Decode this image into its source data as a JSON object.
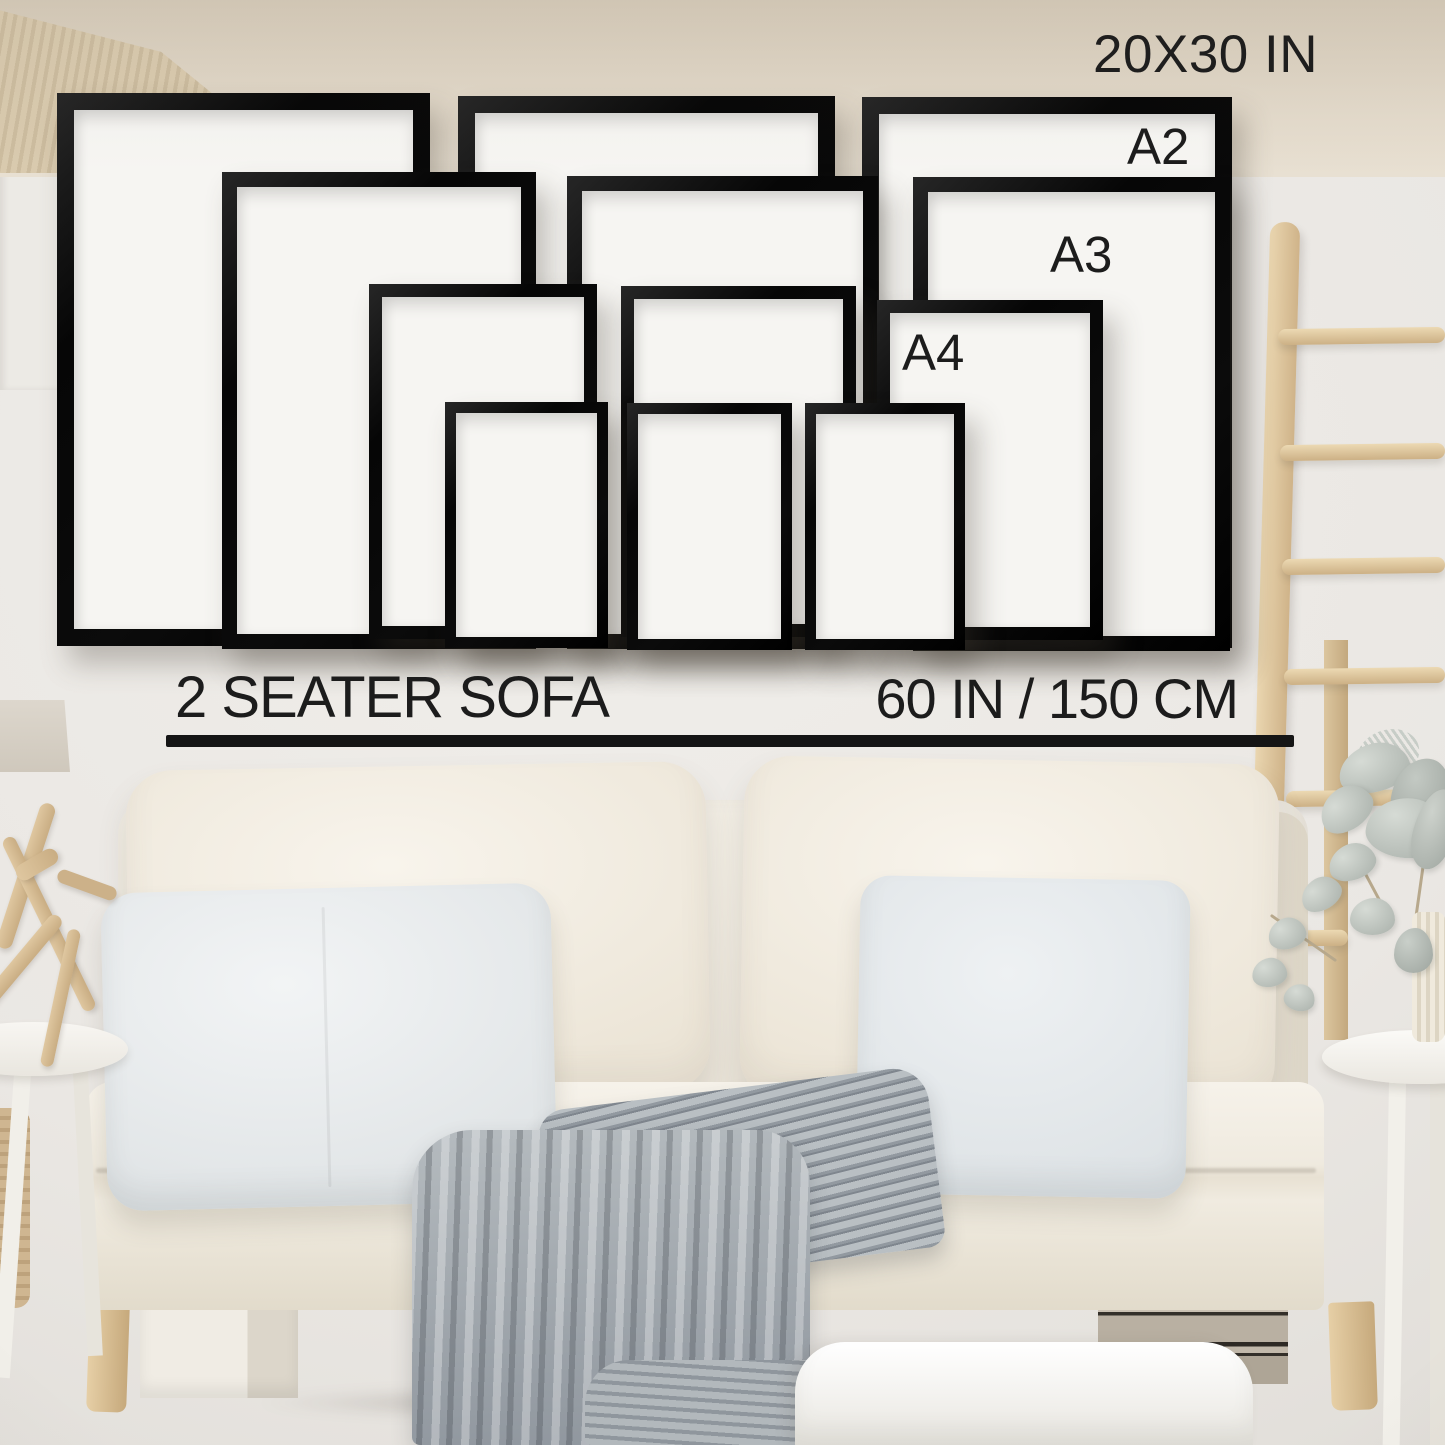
{
  "labels": {
    "largest_size": "20X30 IN",
    "a2": "A2",
    "a3": "A3",
    "a4": "A4",
    "sofa": "2 SEATER SOFA",
    "sofa_width": "60 IN / 150 CM"
  },
  "diagram": {
    "type": "wall-art-size-guide",
    "description": "Twelve black picture frames in four print sizes shown to scale on a wall above a two seater sofa",
    "frame_rows": [
      {
        "size": "20X30 IN",
        "count": 3
      },
      {
        "size": "A2",
        "count": 3
      },
      {
        "size": "A3",
        "count": 3
      },
      {
        "size": "A4",
        "count": 3
      }
    ],
    "reference_object": {
      "name": "2 SEATER SOFA",
      "width": "60 IN / 150 CM"
    }
  },
  "frames": [
    {
      "size": "20x30-in",
      "col": 1,
      "x": 57,
      "y": 93,
      "w": 373,
      "h": 553,
      "b": 17,
      "z": 10
    },
    {
      "size": "20x30-in",
      "col": 2,
      "x": 458,
      "y": 96,
      "w": 377,
      "h": 550,
      "b": 17,
      "z": 10
    },
    {
      "size": "20x30-in",
      "col": 3,
      "x": 862,
      "y": 97,
      "w": 370,
      "h": 551,
      "b": 17,
      "z": 10
    },
    {
      "size": "a2",
      "col": 1,
      "x": 222,
      "y": 172,
      "w": 314,
      "h": 477,
      "b": 15,
      "z": 11
    },
    {
      "size": "a2",
      "col": 2,
      "x": 567,
      "y": 176,
      "w": 311,
      "h": 473,
      "b": 15,
      "z": 11
    },
    {
      "size": "a2",
      "col": 3,
      "x": 913,
      "y": 177,
      "w": 317,
      "h": 474,
      "b": 15,
      "z": 11
    },
    {
      "size": "a3",
      "col": 1,
      "x": 369,
      "y": 284,
      "w": 228,
      "h": 355,
      "b": 13,
      "z": 12
    },
    {
      "size": "a3",
      "col": 2,
      "x": 621,
      "y": 286,
      "w": 235,
      "h": 351,
      "b": 13,
      "z": 12
    },
    {
      "size": "a3",
      "col": 3,
      "x": 877,
      "y": 300,
      "w": 226,
      "h": 340,
      "b": 13,
      "z": 12
    },
    {
      "size": "a4",
      "col": 1,
      "x": 445,
      "y": 402,
      "w": 163,
      "h": 246,
      "b": 11,
      "z": 13
    },
    {
      "size": "a4",
      "col": 2,
      "x": 627,
      "y": 403,
      "w": 165,
      "h": 247,
      "b": 11,
      "z": 13
    },
    {
      "size": "a4",
      "col": 3,
      "x": 805,
      "y": 403,
      "w": 160,
      "h": 247,
      "b": 11,
      "z": 13
    }
  ],
  "colors": {
    "wall": "#e9e6e2",
    "frame_black": "#0b0b0b",
    "frame_mat": "#f6f5f2",
    "text": "#1c1c1c",
    "sofa_cream": "#f1ede3",
    "pillow_gray_white": "#e9edee",
    "blanket_gray": "#a7adb2",
    "wood_light": "#e0c9a3",
    "carpet_beige": "#ddd3c3",
    "plant_sage": "#b9bfba"
  }
}
